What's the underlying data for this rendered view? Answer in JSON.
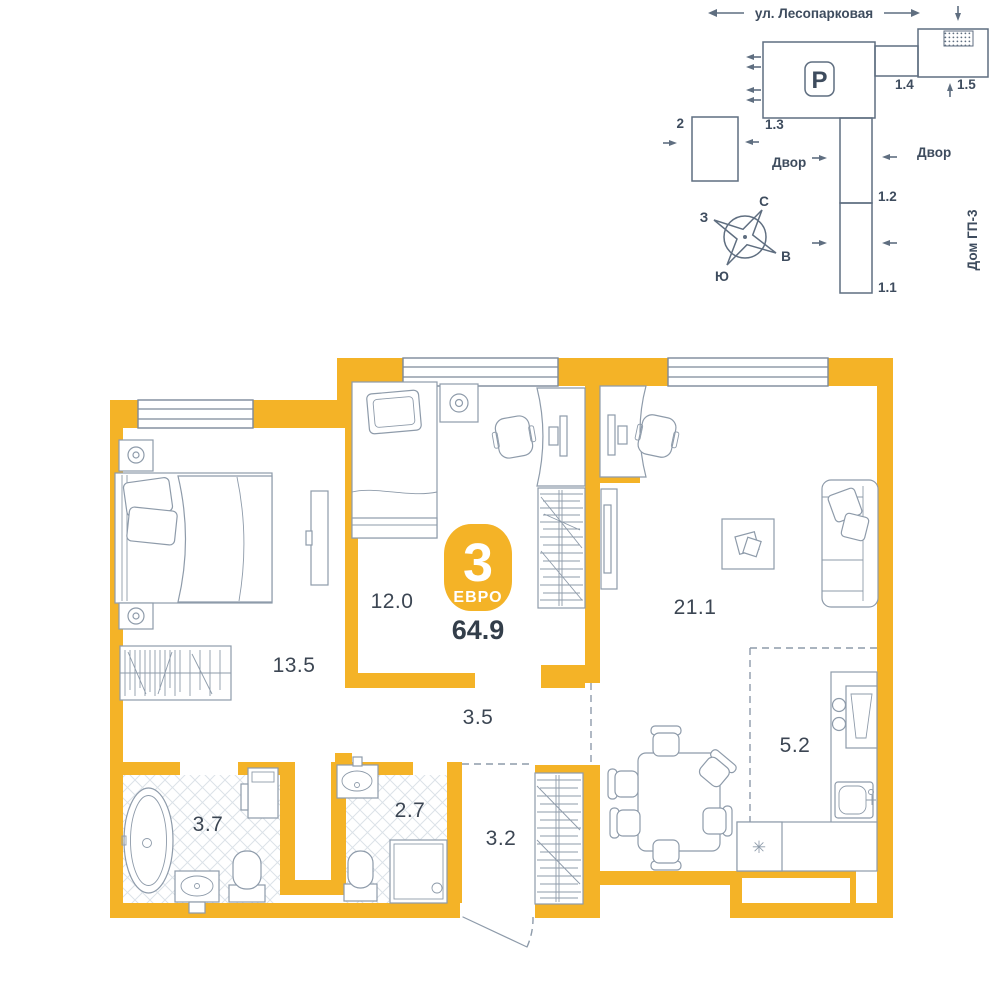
{
  "site_plan": {
    "street": "ул. Лесопарковая",
    "parking_label": "P",
    "yard_left": "Двор",
    "yard_right": "Двор",
    "house_label": "Дом ГП-3",
    "buildings": {
      "b2": "2",
      "b1_3": "1.3",
      "b1_4": "1.4",
      "b1_5": "1.5",
      "b1_2": "1.2",
      "b1_1": "1.1"
    },
    "compass": {
      "north": "С",
      "south": "Ю",
      "west": "З",
      "east": "В"
    }
  },
  "floor_plan": {
    "badge": {
      "rooms_count": "3",
      "format": "ЕВРО",
      "total_area": "64.9"
    },
    "room_areas": {
      "bedroom_large": "13.5",
      "bedroom_small": "12.0",
      "living_kitchen": "21.1",
      "hallway": "3.5",
      "bathroom": "3.7",
      "wc": "2.7",
      "entry": "3.2",
      "kitchen_zone": "5.2"
    },
    "fridge_symbol": "✳"
  },
  "colors": {
    "wall": "#F4B327",
    "line": "#8E9BAA",
    "dark": "#5F6E80",
    "text": "#3C4653",
    "badge_text": "#FFFFFF",
    "hatch": "#DCE2E8"
  }
}
